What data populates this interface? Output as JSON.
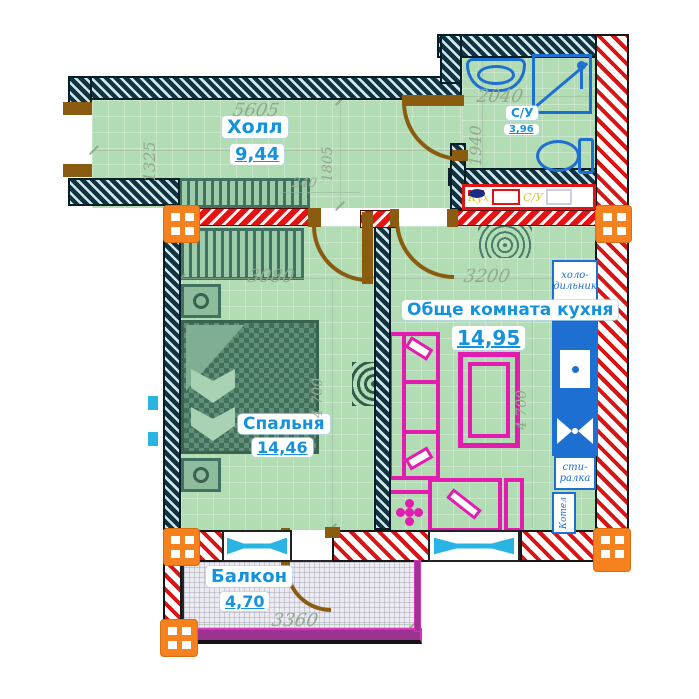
{
  "rooms": {
    "hall": {
      "name": "Холл",
      "area": "9,44"
    },
    "bathroom": {
      "name": "С/У",
      "area": "3,96"
    },
    "living": {
      "name": "Обще комната кухня",
      "area": "14,95"
    },
    "bedroom": {
      "name": "Спальня",
      "area": "14,46"
    },
    "balcony": {
      "name": "Балкон",
      "area": "4,70"
    }
  },
  "dimensions_mm": {
    "hall_width": "5605",
    "hall_depth": "1325",
    "hall_inner": "1805",
    "doorway": "240",
    "bathroom_width": "2040",
    "bathroom_depth": "1940",
    "bedroom_width": "3080",
    "bedroom_depth": "4 700",
    "living_width": "3200",
    "living_depth": "4 700",
    "balcony_width": "3360"
  },
  "appliances": {
    "fridge_line1": "холо-",
    "fridge_line2": "дильник",
    "washer_line1": "сти-",
    "washer_line2": "ралка",
    "boiler": "Котел",
    "kitchen_unit": "Кух",
    "kitchen_sink": "С/У"
  },
  "colors": {
    "floor_green": "#b2dcb4",
    "balcony_floor": "#ebebf1",
    "wall_hatch_teal": "#11323f",
    "wall_red": "#d81414",
    "column_orange": "#f5821f",
    "door_brown": "#8a5c12",
    "furniture_magenta": "#e21cae",
    "fixture_blue": "#1e6fd2",
    "window_cyan": "#2ab4e4",
    "label_blue": "#1592dc",
    "dim_text": "#93a98f",
    "furniture_green": "#3f7261"
  }
}
